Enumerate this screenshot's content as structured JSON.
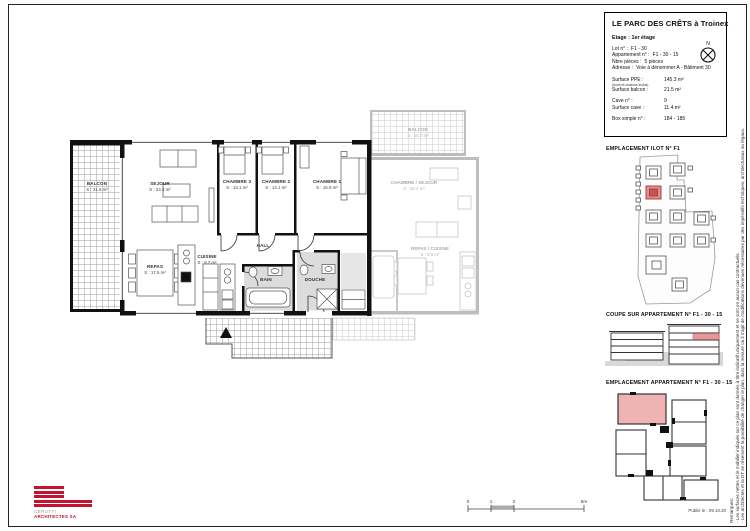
{
  "colors": {
    "accent_red": "#c41230",
    "highlight_fill": "#efb3b3",
    "wall_black": "#111111",
    "neighbor_gray": "#bdbdbd"
  },
  "title_block": {
    "title": "LE PARC DES CRÊTS à Troinex",
    "etage": "Etage : 1er étage",
    "north_label": "N",
    "rows": [
      {
        "label": "Lot n° :",
        "value": "F1 - 30"
      },
      {
        "label": "Appartement n° :",
        "value": "F1 - 30 - 15"
      },
      {
        "label": "Nbre pièces :",
        "value": "5 pièces"
      },
      {
        "label": "Adresse :",
        "value": "Voie à dénommer A - Bâtiment 30"
      }
    ],
    "surface_rows": [
      {
        "label": "Surface PPE :",
        "note": "(murs et cloisons inclus)",
        "value": "145.3 m²"
      },
      {
        "label": "Surface balcon :",
        "value": "21.5 m²"
      },
      {
        "label": "Cave n° :",
        "value": "9"
      },
      {
        "label": "Surface cave :",
        "value": "11.4 m²"
      },
      {
        "label": "Box simple n° :",
        "value": "184 - 185"
      }
    ]
  },
  "sections": {
    "ilot_heading": "EMPLACEMENT ILOT N° F1",
    "coupe_heading": "COUPE SUR APPARTEMENT N° F1 - 30 - 15",
    "apartment_heading": "EMPLACEMENT APPARTEMENT N° F1 - 30 - 15",
    "published": "Publié le : 09.10.20"
  },
  "remarks": {
    "heading": "Remarques:",
    "line1": "- Les surfaces nettes et le mobilier indiqués sur ce plan sont donnés à titre indicatif uniquement et ne sont en aucun cas contractuels.",
    "line2": "- Les architectes et la DT se réservent la possibilité de changer le plan, dans la mesure où il s'agit de modifications devenues nécessaires par des impératifs techniques, architecturaux ou légaux."
  },
  "plan": {
    "rooms": [
      {
        "name": "BALCON",
        "area": "S : 21.5 m²"
      },
      {
        "name": "SEJOUR",
        "area": "S : 23.3 m²"
      },
      {
        "name": "CHAMBRE 3",
        "area": "S : 13.1 m²"
      },
      {
        "name": "CHAMBRE 2",
        "area": "S : 13.1 m²"
      },
      {
        "name": "CHAMBRE 1",
        "area": "S : 16.9 m²"
      },
      {
        "name": "REPAS",
        "area": "S : 17.5 m²"
      },
      {
        "name": "CUISINE",
        "area": "S : 9.7 m²"
      },
      {
        "name": "HALL",
        "area": ""
      },
      {
        "name": "BAIN",
        "area": ""
      },
      {
        "name": "DOUCHE",
        "area": ""
      }
    ],
    "neighbor_rooms": [
      {
        "name": "BALCON",
        "area": "S : 10.0 m²"
      },
      {
        "name": "CHAMBRE / SEJOUR",
        "area": "S : 28.4 m²"
      },
      {
        "name": "REPAS / CUISINE",
        "area": "S : 9.9 m²"
      }
    ]
  },
  "scale_bar": {
    "ticks": [
      "0",
      "1",
      "2",
      "5m"
    ]
  },
  "logo": {
    "name": "CERUTTI",
    "suffix": "ARCHITECTES SA"
  }
}
